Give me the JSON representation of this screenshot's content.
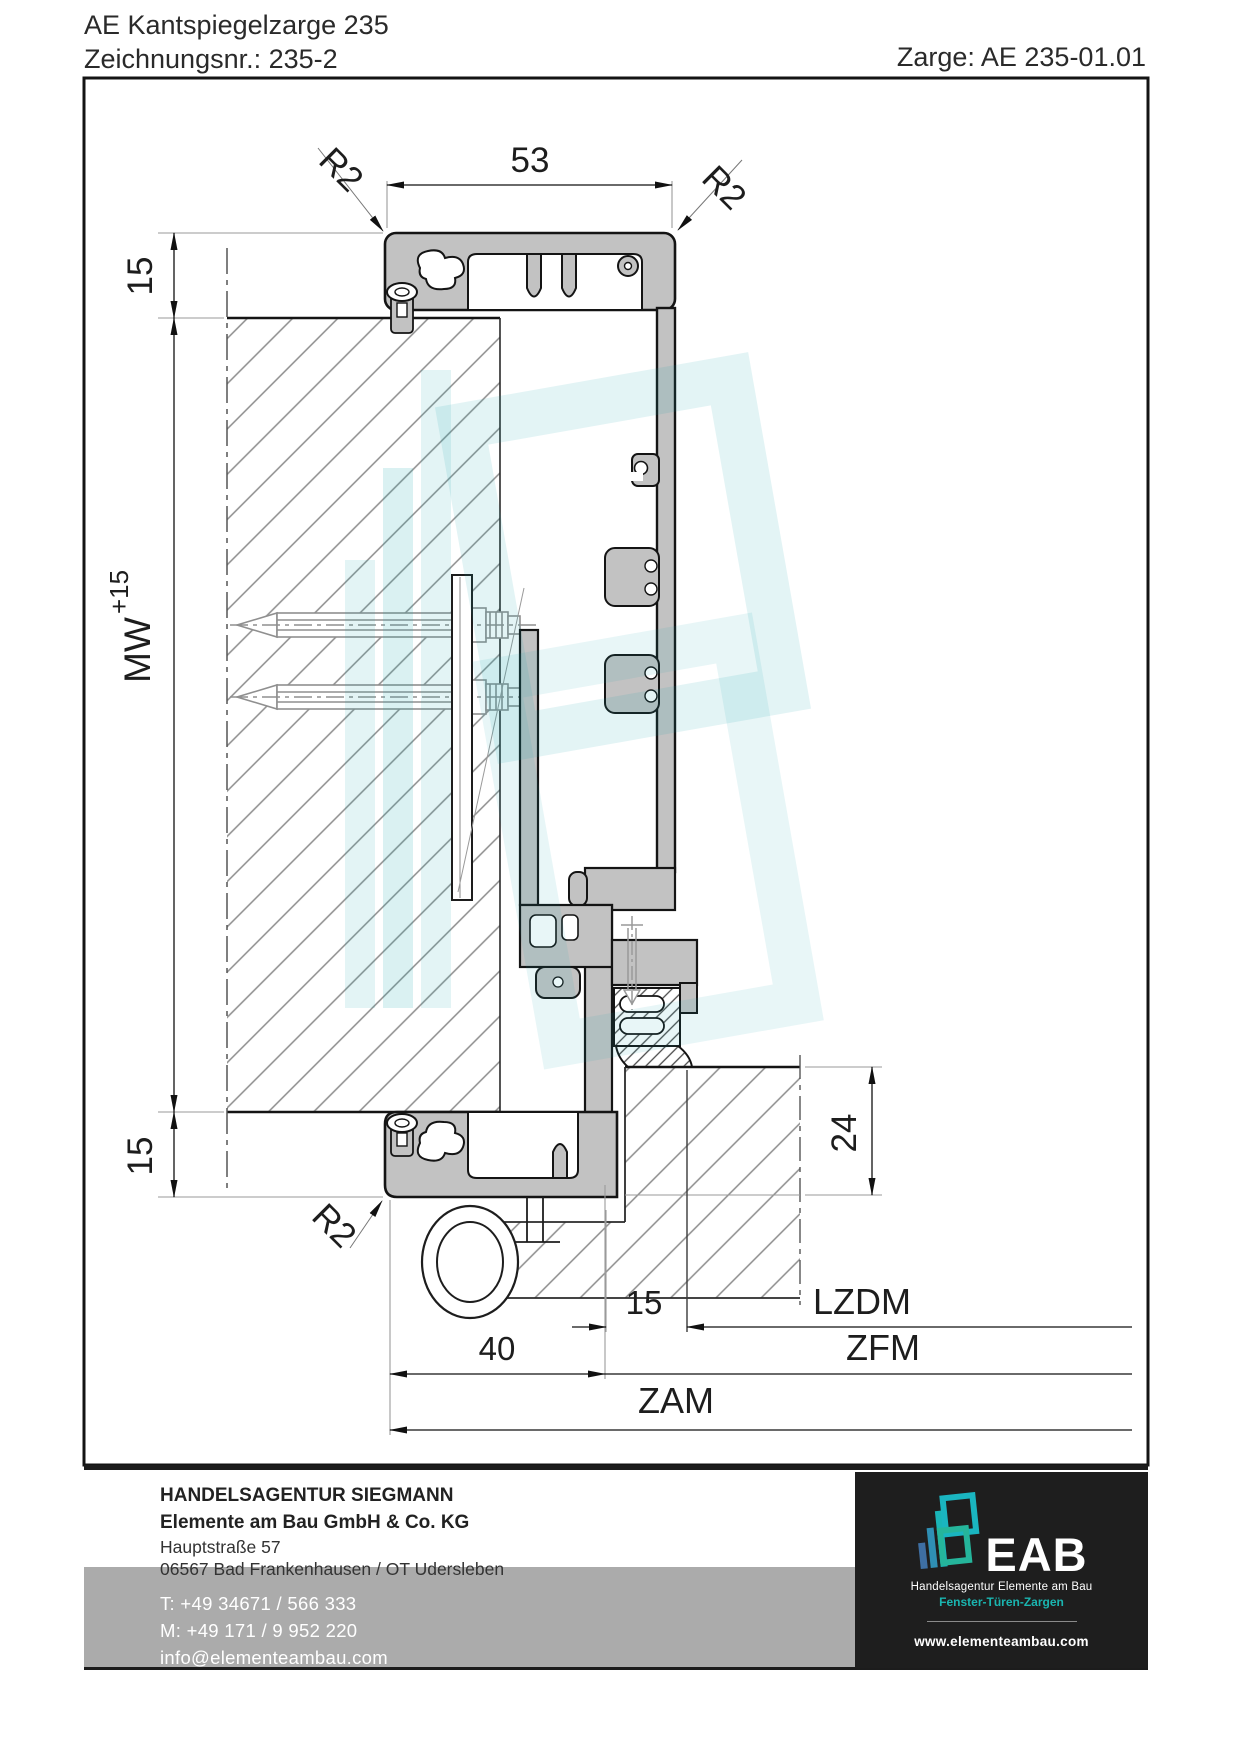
{
  "header": {
    "title": "AE Kantspiegelzarge 235",
    "drawing_no": "Zeichnungsnr.: 235-2",
    "frame_ref": "Zarge: AE 235-01.01"
  },
  "dims": {
    "w53": "53",
    "r2": "R2",
    "t15": "15",
    "mw": "MW",
    "mw_sup": "+15",
    "b15": "15",
    "d24": "24",
    "c15": "15",
    "d40": "40",
    "lzdm": "LZDM",
    "zfm": "ZFM",
    "zam": "ZAM"
  },
  "footer": {
    "company_line1": "HANDELSAGENTUR SIEGMANN",
    "company_line2": "Elemente am Bau GmbH & Co. KG",
    "address_line1": "Hauptstraße 57",
    "address_line2": "06567 Bad Frankenhausen / OT Udersleben",
    "phone": "T: +49 34671 / 566 333",
    "mobile": "M: +49 171 / 9 952 220",
    "email": "info@elementeambau.com",
    "logo_name": "EAB",
    "logo_tagline1": "Handelsagentur Elemente am Bau",
    "logo_tagline2": "Fenster-Türen-Zargen",
    "logo_website": "www.elementeambau.com"
  },
  "colors": {
    "accent_teal": "#1ab5b0",
    "profile_gray": "#c2c2c2",
    "dark_bg": "#1e1e1e",
    "gray_band": "#ababab"
  }
}
